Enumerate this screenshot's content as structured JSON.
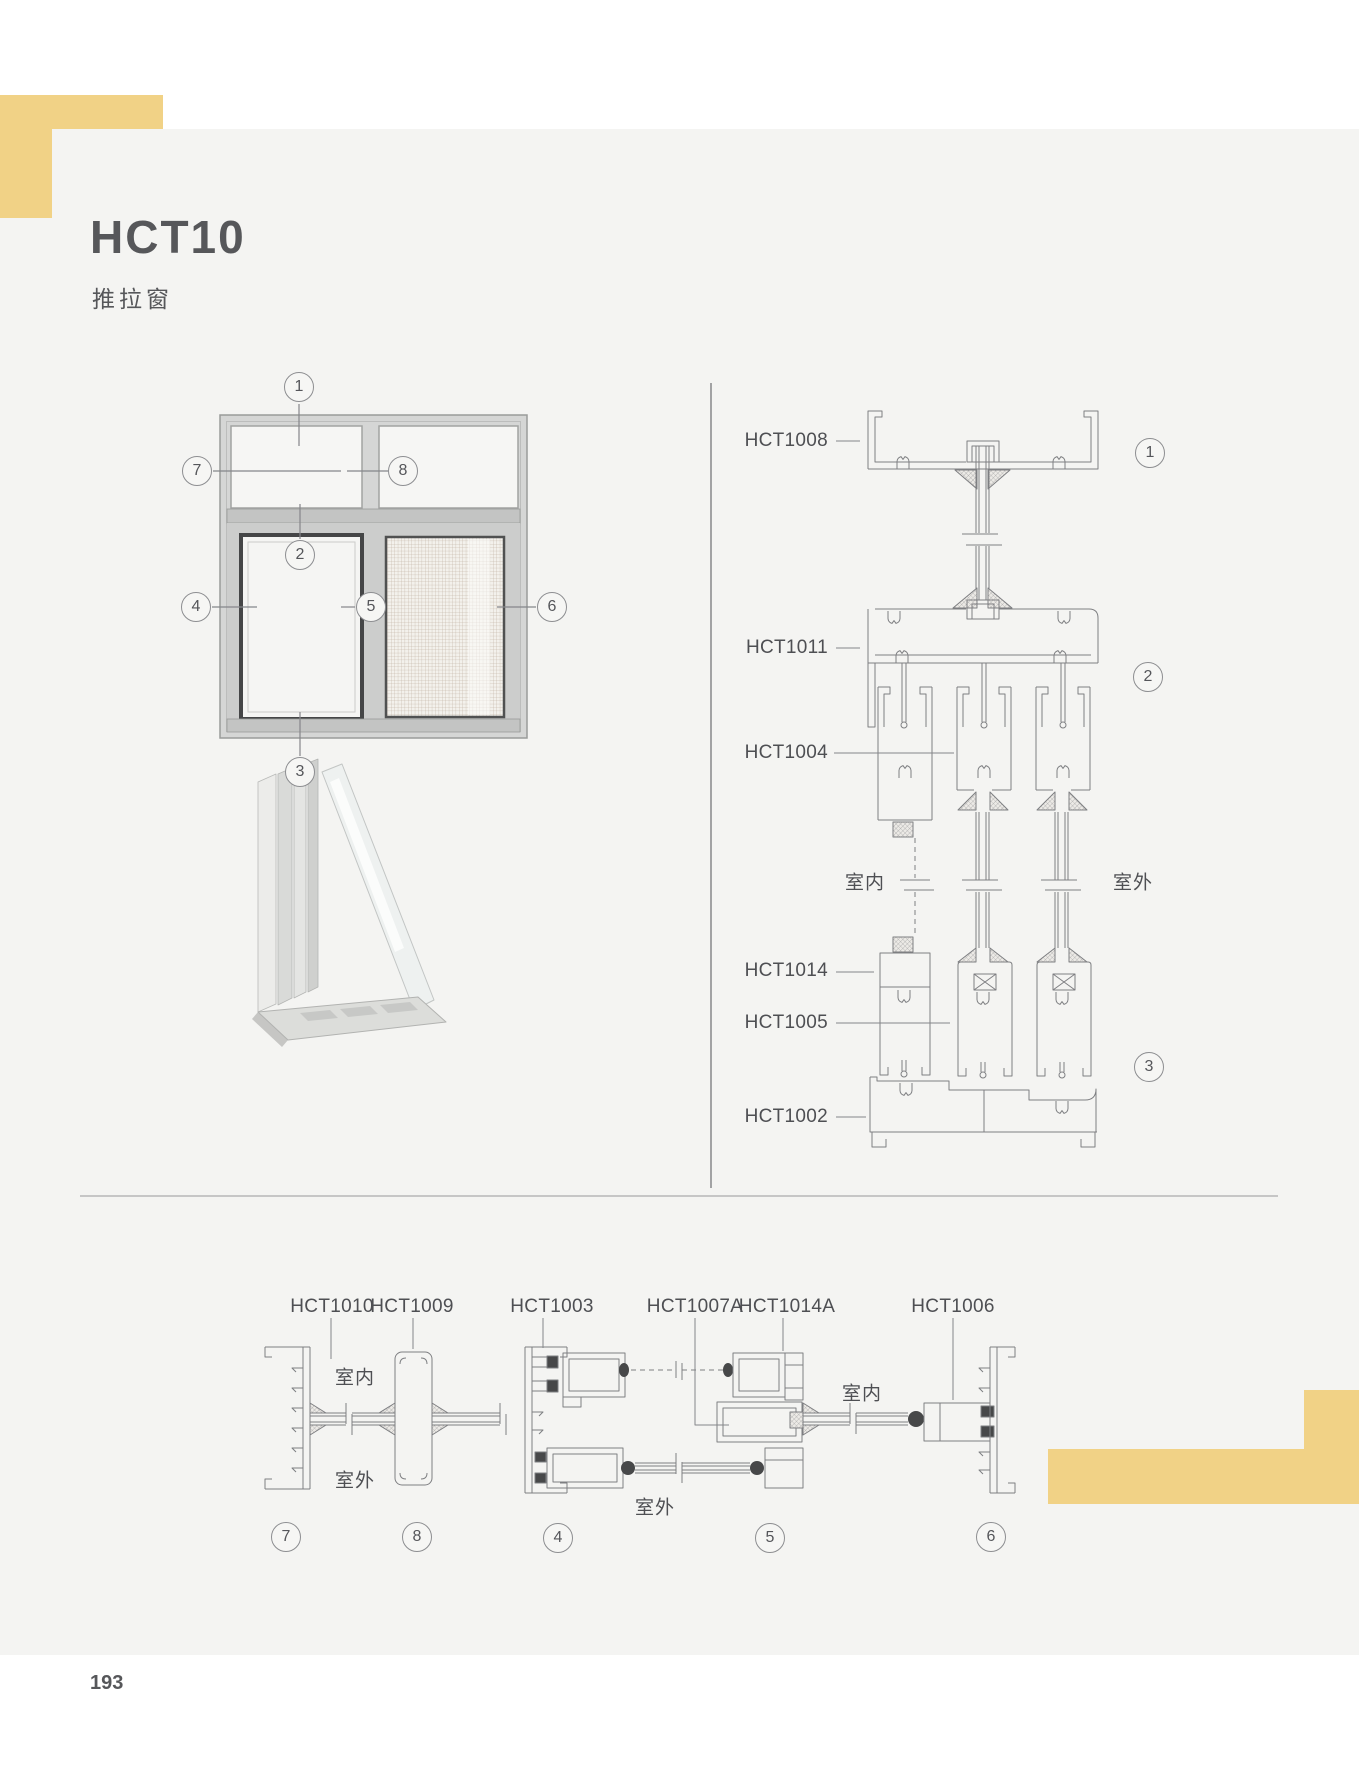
{
  "header": {
    "title": "HCT10",
    "subtitle": "推拉窗"
  },
  "footer": {
    "page_number": "193"
  },
  "rooms": {
    "indoor": "室内",
    "outdoor": "室外"
  },
  "callouts": {
    "c1": "1",
    "c2": "2",
    "c3": "3",
    "c4": "4",
    "c5": "5",
    "c6": "6",
    "c7": "7",
    "c8": "8"
  },
  "profiles": {
    "hct1008": "HCT1008",
    "hct1011": "HCT1011",
    "hct1004": "HCT1004",
    "hct1014": "HCT1014",
    "hct1005": "HCT1005",
    "hct1002": "HCT1002",
    "hct1010": "HCT1010",
    "hct1009": "HCT1009",
    "hct1003": "HCT1003",
    "hct1007a": "HCT1007A",
    "hct1014a": "HCT1014A",
    "hct1006": "HCT1006"
  },
  "colors": {
    "accent_yellow": "#f1d286",
    "panel_gray": "#f4f4f2",
    "line": "#7e7f82",
    "text": "#56575a"
  }
}
